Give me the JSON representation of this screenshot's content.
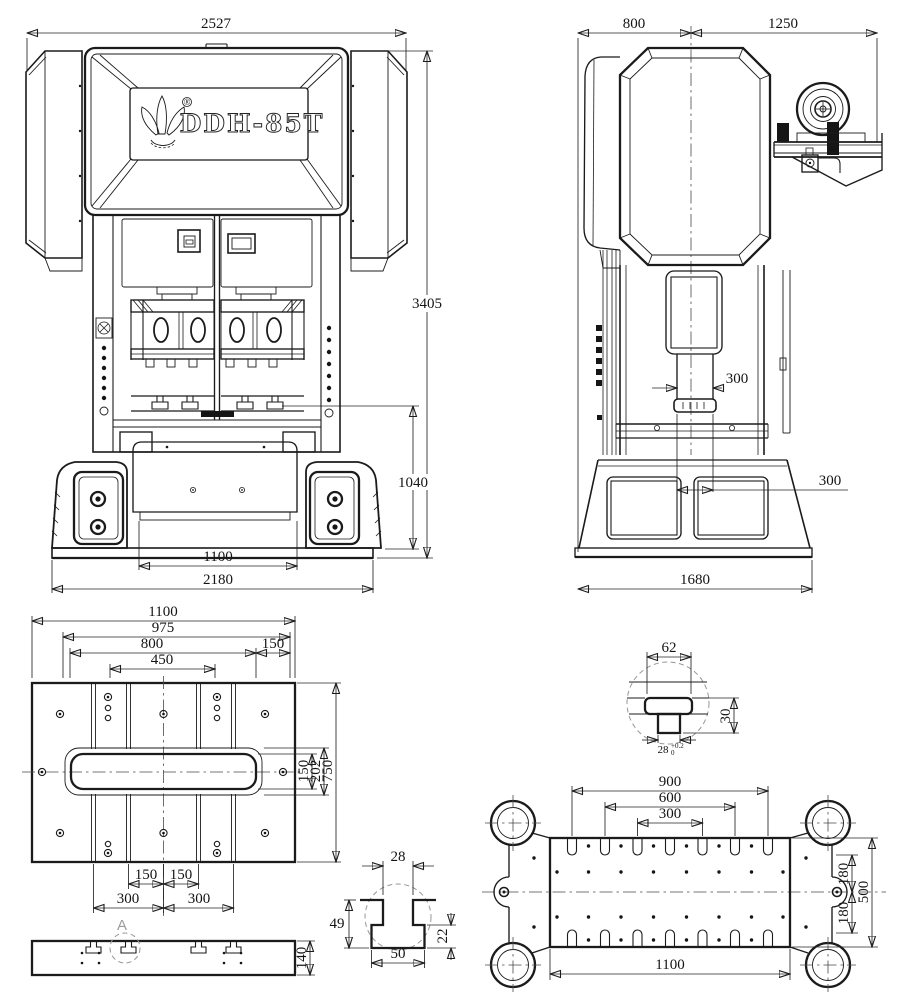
{
  "brand": {
    "name": "DDH-85T",
    "reg": "®"
  },
  "front": {
    "overall_width": "2527",
    "overall_height": "3405",
    "table_height": "1040",
    "opening_width": "1100",
    "base_width": "2180"
  },
  "side": {
    "depth_rear": "800",
    "depth_front": "1250",
    "ram_dia": "300",
    "ram_offset": "300",
    "base_depth": "1680"
  },
  "bolster": {
    "width": "1100",
    "w975": "975",
    "w800": "800",
    "w150": "150",
    "w450": "450",
    "slot_h150": "150",
    "slot_h202": "202",
    "depth750": "750",
    "p150a": "150",
    "p150b": "150",
    "p300a": "300",
    "p300b": "300",
    "thickness": "140",
    "detail_label": "A"
  },
  "tslot": {
    "neck": "28",
    "depth": "49",
    "cavity": "22",
    "width": "50"
  },
  "tnut": {
    "width": "62",
    "height": "30",
    "neck": "28",
    "tol_upper": "+0.2",
    "tol_lower": "0"
  },
  "slide": {
    "p900": "900",
    "p600": "600",
    "p300": "300",
    "d180a": "180",
    "d180b": "180",
    "d500": "500",
    "width": "1100"
  }
}
